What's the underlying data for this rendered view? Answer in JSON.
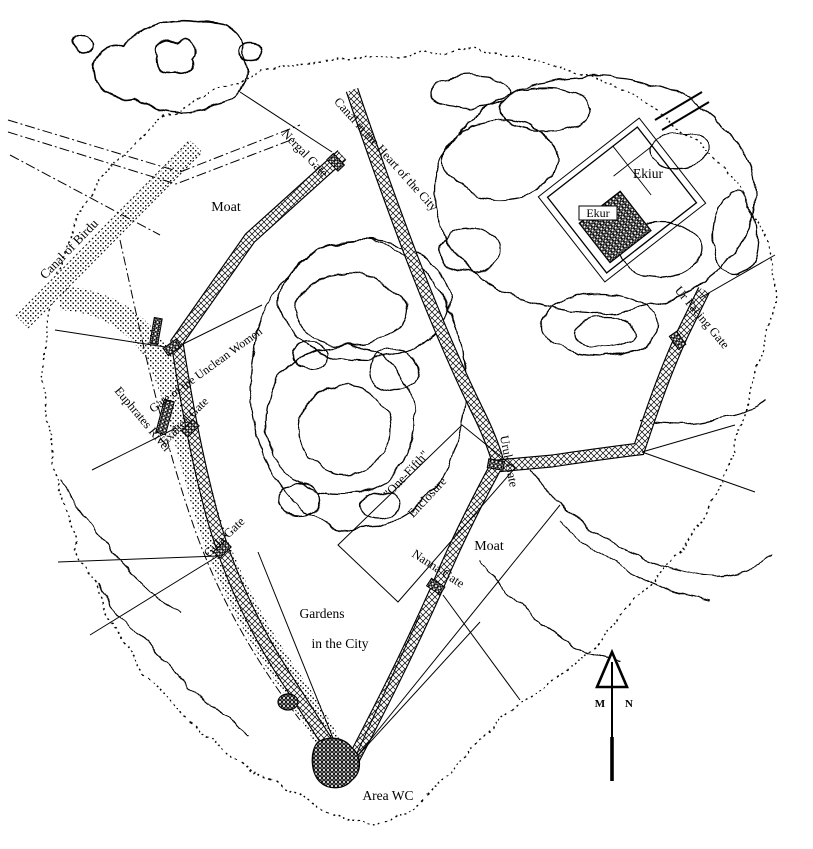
{
  "map": {
    "kind": "archaeological-site-plan",
    "colors": {
      "ink": "#000000",
      "paper": "#ffffff"
    },
    "labels": {
      "canal_of_birdu": "Canal of Birdu",
      "moat_nw": "Moat",
      "canal_heart": "Canal in the Heart of the City",
      "nergal_gate": "Nergal Gate",
      "ekiur": "Ekiur",
      "ekur": "Ekur",
      "ur_facing_gate": "Ur Facing Gate",
      "gate_unclean_women": "Gate of the Unclean Women",
      "exalted_gate": "Exalted Gate",
      "euphrates_river": "Euphrates River",
      "gula_gate": "Gula Gate",
      "one_fifth_line1": "\"One-Fifth\"",
      "one_fifth_line2": "Enclosure",
      "uruk_gate": "Uruk Gate",
      "moat_se": "Moat",
      "nanna_gate": "Nanna Gate",
      "gardens_line1": "Gardens",
      "gardens_line2": "in the City",
      "area_wc": "Area WC",
      "compass_m": "M",
      "compass_n": "N"
    }
  }
}
